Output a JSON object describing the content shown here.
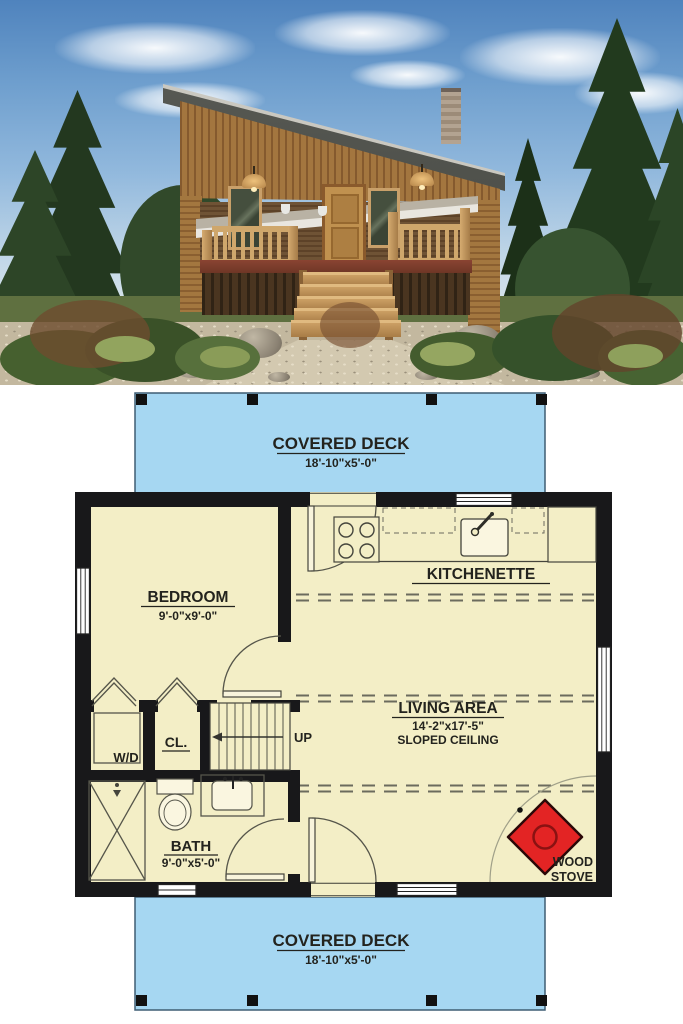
{
  "photo": {
    "name": "cabin-exterior-render"
  },
  "plan": {
    "deck_top": {
      "label": "COVERED DECK",
      "dims": "18'-10\"x5'-0\""
    },
    "deck_bottom": {
      "label": "COVERED DECK",
      "dims": "18'-10\"x5'-0\""
    },
    "bedroom": {
      "label": "BEDROOM",
      "dims": "9'-0\"x9'-0\""
    },
    "kitchenette": {
      "label": "KITCHENETTE"
    },
    "living": {
      "label": "LIVING AREA",
      "dims": "14'-2\"x17'-5\"",
      "note": "SLOPED CEILING"
    },
    "bath": {
      "label": "BATH",
      "dims": "9'-0\"x5'-0\""
    },
    "closet": {
      "label": "CL."
    },
    "laundry": {
      "label": "W/D"
    },
    "stairs": {
      "label": "UP"
    },
    "wood_stove": {
      "line1": "WOOD",
      "line2": "STOVE"
    },
    "colors": {
      "deck": "#a6d7f2",
      "floor": "#f3eec6",
      "wall": "#18181a",
      "stove": "#e32424"
    }
  }
}
